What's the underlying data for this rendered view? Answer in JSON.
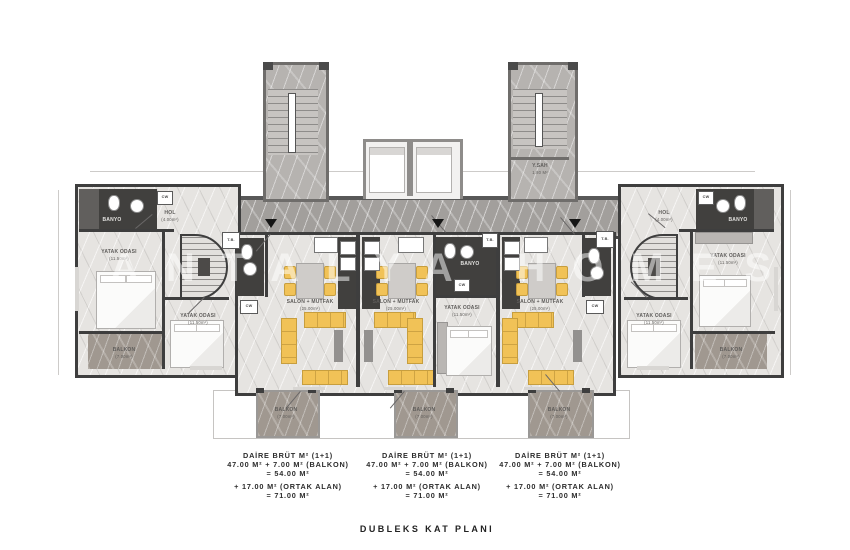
{
  "plan": {
    "watermark": "ANTALYA HOMES",
    "title": "DUBLEKS KAT PLANI"
  },
  "legend_blocks": [
    {
      "l1": "DAİRE BRÜT M² (1+1)",
      "l2": "47.00 M² + 7.00 M² (BALKON)",
      "l3": "= 54.00 M²",
      "l4": "+ 17.00 M² (ORTAK ALAN)",
      "l5": "= 71.00 M²"
    },
    {
      "l1": "DAİRE BRÜT M² (1+1)",
      "l2": "47.00 M² + 7.00 M² (BALKON)",
      "l3": "= 54.00 M²",
      "l4": "+ 17.00 M² (ORTAK ALAN)",
      "l5": "= 71.00 M²"
    },
    {
      "l1": "DAİRE BRÜT M² (1+1)",
      "l2": "47.00 M² + 7.00 M² (BALKON)",
      "l3": "= 54.00 M²",
      "l4": "+ 17.00 M² (ORTAK ALAN)",
      "l5": "= 71.00 M²"
    }
  ],
  "rooms": {
    "salon": "SALON + MUTFAK",
    "salon_area": "(25.00m²)",
    "bedroom": "YATAK ODASI",
    "bedroom_area": "(11.50m²)",
    "balcony": "BALKON",
    "balcony_area": "(7.00m²)",
    "hall": "HOL",
    "hall_area": "(4.00m²)",
    "bath": "BANYO",
    "closet": "CW",
    "tb": "T.B.",
    "shaft": "Y.SAH",
    "shaft_area": "1.80 M²"
  },
  "colors": {
    "wall": "#3e3e3e",
    "tower_wall": "#6f6d6b",
    "floor": "#e6e4e1",
    "corridor": "#a29f9c",
    "balcony_floor": "#a09890",
    "dark_room": "#41403e",
    "furniture_yellow": "#f1c257"
  }
}
